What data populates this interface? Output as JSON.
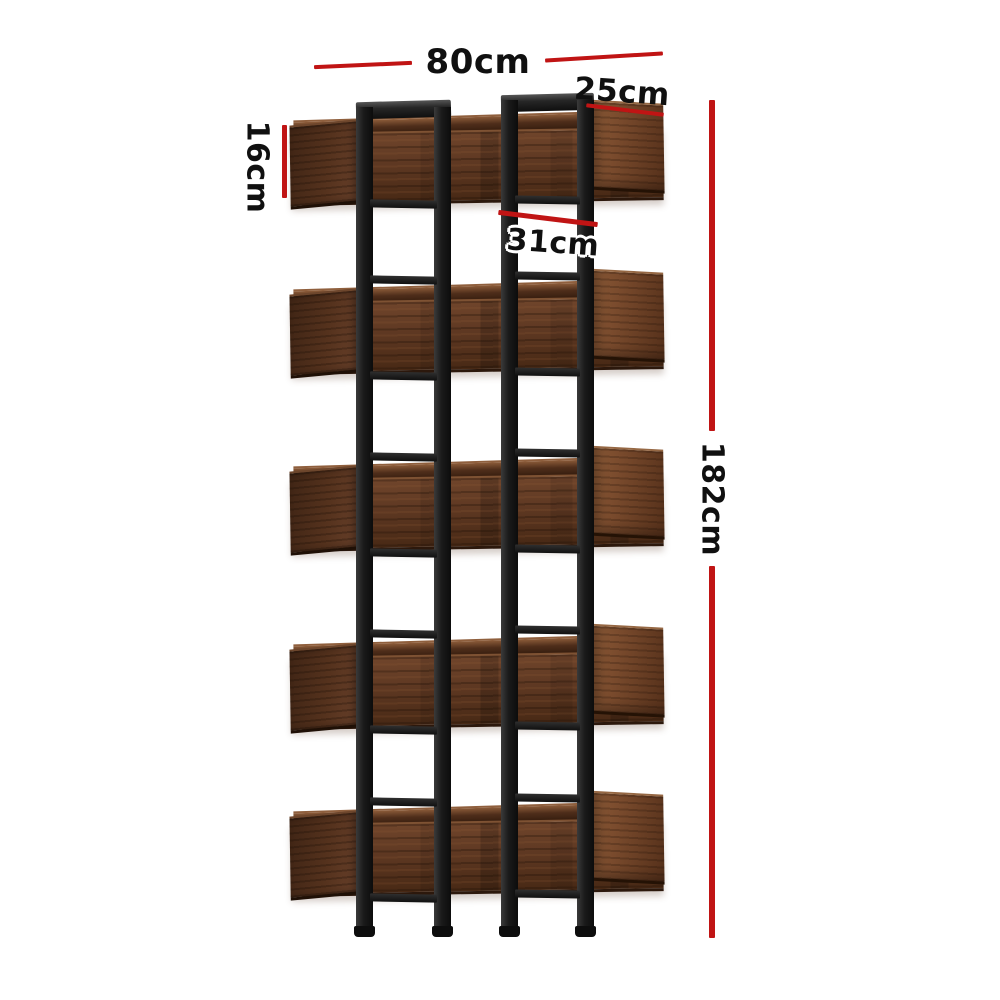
{
  "scene": {
    "type": "furniture dimension diagram",
    "product": "5-tier staggered open bookshelf with black metal frame and walnut wood shelf boxes",
    "shelf_count": 5,
    "background": "#ffffff"
  },
  "dimensions": {
    "width": "80cm",
    "depth": "25cm",
    "shelf_height": "16cm",
    "shelf_spacing": "31cm",
    "total_height": "182cm"
  },
  "colors": {
    "dimension_red": "#c01414",
    "label_black": "#101010",
    "frame_black": "#1c1c1c",
    "wood_mid": "#5e3822",
    "wood_dark": "#331c0e",
    "wood_light": "#8a5a38",
    "background": "#ffffff"
  }
}
